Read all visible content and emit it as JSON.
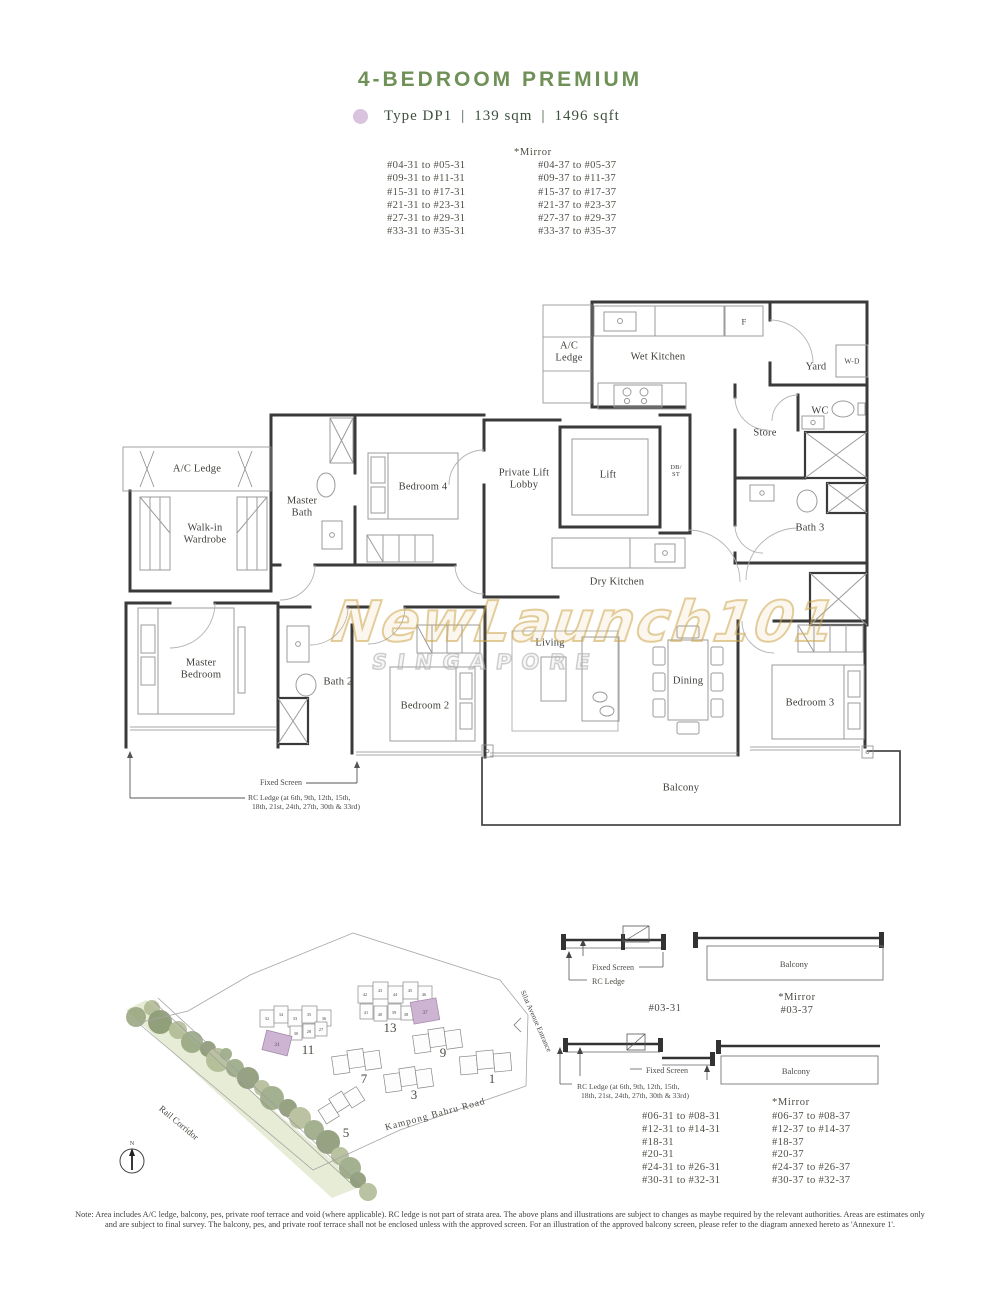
{
  "header": {
    "title": "4-BEDROOM PREMIUM",
    "type": "Type DP1",
    "area_sqm": "139 sqm",
    "area_sqft": "1496 sqft",
    "sep": "|"
  },
  "top_units": {
    "mirror_header": "*Mirror",
    "left": [
      "#04-31 to #05-31",
      "#09-31 to #11-31",
      "#15-31 to #17-31",
      "#21-31 to #23-31",
      "#27-31 to #29-31",
      "#33-31 to #35-31"
    ],
    "right": [
      "#04-37 to #05-37",
      "#09-37 to #11-37",
      "#15-37 to #17-37",
      "#21-37 to #23-37",
      "#27-37 to #29-37",
      "#33-37 to #35-37"
    ]
  },
  "plan": {
    "rooms": {
      "ac_ledge_top": "A/C Ledge",
      "wet_kitchen": "Wet Kitchen",
      "fridge": "F",
      "yard": "Yard",
      "washer_dryer": "W-D",
      "wc": "WC",
      "store": "Store",
      "ac_ledge_left": "A/C Ledge",
      "master_bath": "Master Bath",
      "bedroom4": "Bedroom 4",
      "lift_lobby": "Private Lift Lobby",
      "lift": "Lift",
      "db_st": "DB/ ST",
      "bath3": "Bath 3",
      "walk_in": "Walk-in Wardrobe",
      "dry_kitchen": "Dry Kitchen",
      "master_bedroom": "Master Bedroom",
      "bath2": "Bath 2",
      "bedroom2": "Bedroom 2",
      "living": "Living",
      "dining": "Dining",
      "bedroom3": "Bedroom 3",
      "balcony": "Balcony"
    },
    "annotations": {
      "fixed_screen": "Fixed Screen",
      "rc_ledge_1": "RC Ledge (at 6th, 9th, 12th, 15th,",
      "rc_ledge_2": "18th, 21st, 24th, 27th, 30th & 33rd)"
    }
  },
  "watermark": {
    "name": "NewLaunch101",
    "sub": "SINGAPORE"
  },
  "site_map": {
    "labels": {
      "rail": "Rail Corridor",
      "road": "Kampong Bahru Road",
      "entrance": "Silat Avenue Entrance",
      "north": "N"
    },
    "blocks": {
      "b1": "1",
      "b3": "3",
      "b5": "5",
      "b7": "7",
      "b9": "9",
      "b11": "11",
      "b13": "13"
    },
    "b11_stacks": [
      "32",
      "34",
      "33",
      "35",
      "36",
      "30",
      "28",
      "27"
    ],
    "b13_stacks": [
      "42",
      "43",
      "44",
      "45",
      "46",
      "41",
      "40",
      "39",
      "38"
    ],
    "highlights": {
      "b11": "31",
      "b13": "37"
    }
  },
  "detail1": {
    "fixed_screen": "Fixed Screen",
    "rc_ledge": "RC Ledge",
    "balcony": "Balcony",
    "unit": "#03-31",
    "mirror_header": "*Mirror",
    "mirror_unit": "#03-37"
  },
  "detail2": {
    "fixed_screen": "Fixed Screen",
    "rc_ledge_1": "RC Ledge (at 6th, 9th, 12th, 15th,",
    "rc_ledge_2": "18th, 21st, 24th, 27th, 30th & 33rd)",
    "balcony": "Balcony",
    "mirror_header": "*Mirror",
    "left": [
      "#06-31 to #08-31",
      "#12-31 to #14-31",
      "#18-31",
      "#20-31",
      "#24-31 to #26-31",
      "#30-31 to #32-31"
    ],
    "right": [
      "#06-37 to #08-37",
      "#12-37 to #14-37",
      "#18-37",
      "#20-37",
      "#24-37 to #26-37",
      "#30-37 to #32-37"
    ]
  },
  "note": {
    "line1": "Note: Area includes A/C ledge, balcony, pes, private roof terrace and void (where applicable). RC ledge is not part of strata area. The above plans and illustrations are subject to changes as maybe required by the relevant authorities. Areas are estimates only",
    "line2": "and are subject to final survey. The balcony, pes, and private roof terrace shall not be enclosed unless with the approved screen. For an illustration of the approved balcony screen, please refer to the diagram annexed hereto as 'Annexure 1'."
  },
  "colors": {
    "title_green": "#6f9158",
    "lilac": "#d9c3de",
    "wall": "#3a3a3a",
    "watermark_gold": "#cda64d"
  }
}
